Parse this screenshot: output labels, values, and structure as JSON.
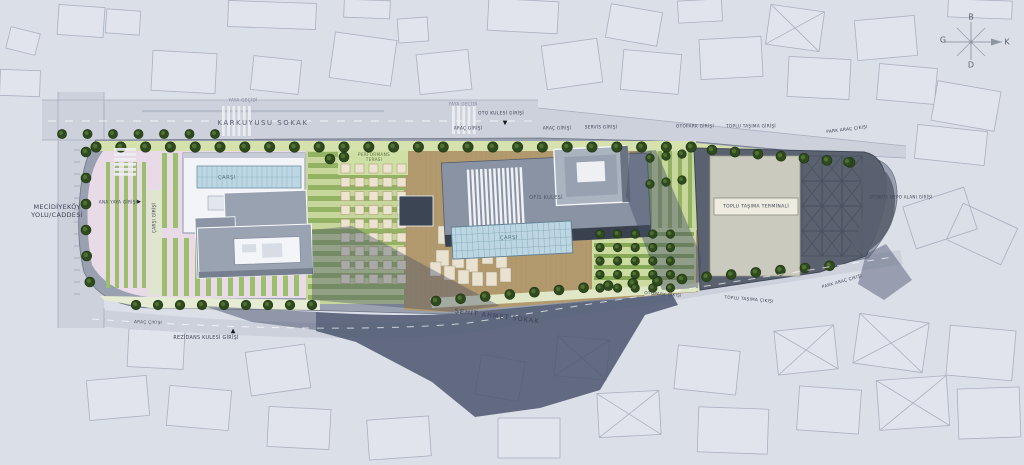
{
  "plan": {
    "streets": {
      "karkuyusu": "KARKUYUSU SOKAK",
      "mecidiyekoy": "MECİDİYEKÖY\nYOLU/CADDESİ",
      "sehit_ahmet": "ŞEHİT AHMET SOKAK"
    },
    "crossings": {
      "yaya_gecidi": "YAYA GEÇİDİ"
    },
    "entrances": {
      "oto_kulesi_girisi": "OTO KULESİ GİRİŞİ",
      "arac_girisi": "ARAÇ GİRİŞİ",
      "servis_girisi": "SERVİS GİRİŞİ",
      "otopark_girisi": "OTOPARK GİRİŞİ",
      "toplu_tasima_girisi": "TOPLU TAŞIMA GİRİŞİ",
      "park_arac_cikisi": "PARK ARAÇ ÇIKIŞI",
      "otobus_depo_girisi": "OTOBÜS DEPO ALANI GİRİŞİ",
      "otopark_cikisi": "OTOPARK ÇIKIŞI",
      "toplu_tasima_cikisi": "TOPLU TAŞIMA ÇIKIŞI",
      "arac_cikisi": "ARAÇ ÇIKIŞI",
      "rezidans_kulesi_girisi": "REZİDANS KULESİ GİRİŞİ",
      "ana_yaya_girisi": "ANA YAYA GİRİŞİ",
      "carsi_girisi": "ÇARŞI GİRİŞİ"
    },
    "areas": {
      "carsi": "ÇARŞI",
      "ofis_kulesi": "OFİS KULESİ",
      "performans_terasi": "PERFORMANS\nTERASI",
      "toplu_tasima_terminali": "TOPLU TAŞIMA TERMİNALİ"
    },
    "compass": {
      "north": "K",
      "south": "G",
      "east": "D",
      "west": "B"
    },
    "markers": {
      "down": "▼",
      "up": "▲",
      "right": "▶"
    },
    "colors": {
      "background": "#dbdfe8",
      "context_outline": "#a9b0bf",
      "street": "#ccd1dc",
      "site_road": "#99a1b0",
      "plaza_pink": "#e8dbe7",
      "garden_green": "#c7d79b",
      "stripe_green": "#93b264",
      "hedge_strip_green": "#d6e2ae",
      "deck_tan": "#b29a6e",
      "glass_blue": "#bcd7e3",
      "building_white": "#f3f4f7",
      "tower_grey": "#9aa3b2",
      "office_grey": "#8993a3",
      "office_dark_edge": "#39414e",
      "terminal_dark": "#5a6270",
      "terminal_beige": "#cacabe",
      "tree_dark_green": "#2e4a1e",
      "shadow_blue": "#46506a",
      "label_text": "#3d4352"
    }
  }
}
